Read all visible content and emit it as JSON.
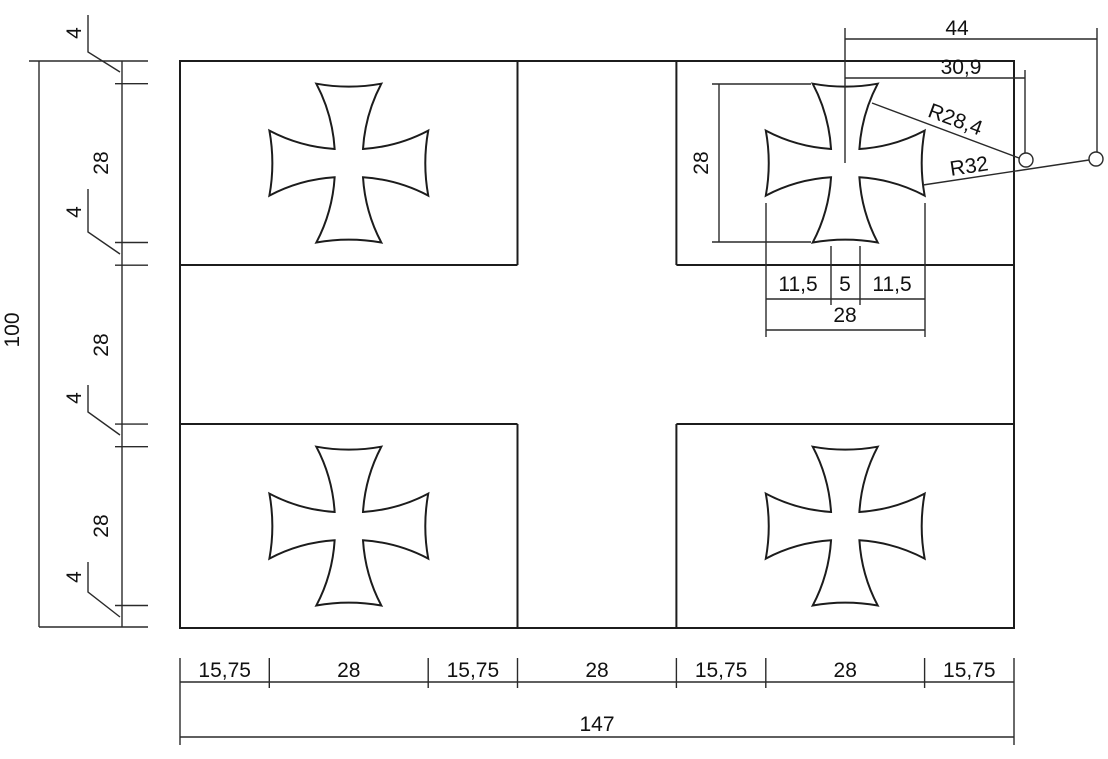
{
  "drawing": {
    "type": "technical-dimension-drawing",
    "subject": "flag with four cross pattee emblems",
    "units_style": "decimal-comma",
    "overall": {
      "width_label": "147",
      "height_label": "100"
    },
    "left_chain": {
      "labels": [
        "4",
        "28",
        "4",
        "28",
        "4",
        "28",
        "4"
      ]
    },
    "bottom_chain": {
      "labels": [
        "15,75",
        "28",
        "15,75",
        "28",
        "15,75",
        "28",
        "15,75"
      ]
    },
    "detail": {
      "cross_height": "28",
      "center_to_end_arc_center": "44",
      "center_to_flank_arc_center": "30,9",
      "flank_radius": "R28,4",
      "end_radius": "R32",
      "waist_chain": [
        "11,5",
        "5",
        "11,5"
      ],
      "cross_width": "28"
    },
    "colors": {
      "line": "#1c1c1c",
      "background": "#ffffff"
    }
  }
}
